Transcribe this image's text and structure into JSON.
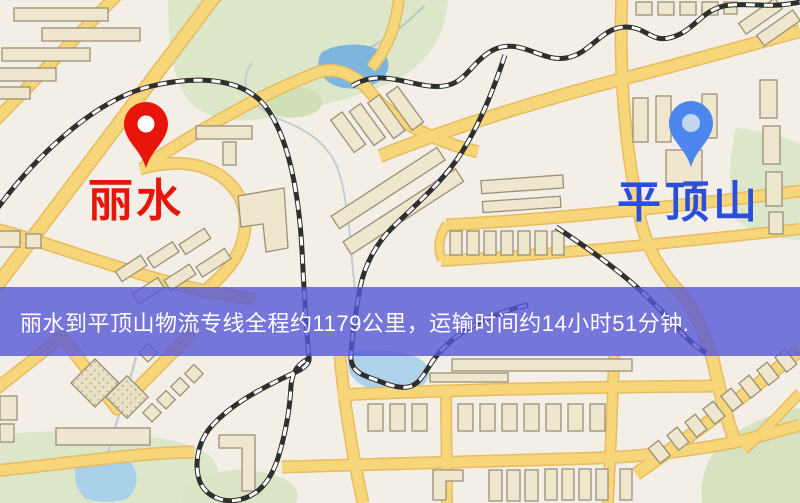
{
  "origin": {
    "label": "丽水",
    "pin_icon": "red-map-pin",
    "pin_color": "#e8150b",
    "label_color": "#e8150b"
  },
  "destination": {
    "label": "平顶山",
    "pin_icon": "blue-map-pin",
    "pin_color": "#4e86ef",
    "label_color": "#2b4fd9"
  },
  "banner": {
    "text": "丽水到平顶山物流专线全程约1179公里，运输时间约14小时51分钟.",
    "background": "#5656d6",
    "text_color": "#ffffff"
  },
  "map_colors": {
    "background": "#f4efe6",
    "road_fill": "#f6d678",
    "road_edge": "#e6bc60",
    "park_green": "#dbe7c8",
    "water_blue": "#7cb5de",
    "building_fill": "#eee6cd",
    "building_outline": "#9a9078",
    "railway_dark": "#2f2f2f"
  }
}
